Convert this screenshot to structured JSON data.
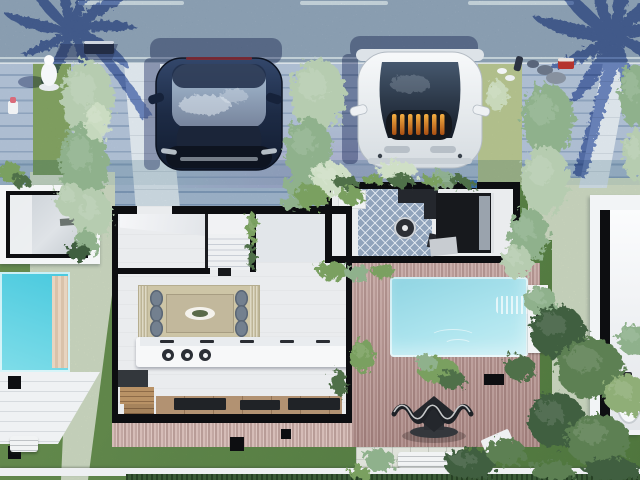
{
  "scene": {
    "description": "Photorealistic top-down 3D render of a modern villa lot between two neighbor houses, with street parking, palm-tree shadows, hedges, pools and gardens",
    "street": {
      "lane_dash_count": 3,
      "edge_lines": "double white sidewalk line",
      "palm_shadow_count": 2
    },
    "vehicles": [
      {
        "id": "suv",
        "label": "dark navy SUV parked on left driveway, nose toward house"
      },
      {
        "id": "sports-car",
        "label": "white sports car with orange engine bay visible under glass canopy"
      }
    ],
    "main_villa": {
      "rooms": [
        {
          "name": "entry hall with staircase"
        },
        {
          "name": "front den bedroom",
          "floor": "blue diamond-pattern tile",
          "furniture": [
            "dark bed with gray pillows",
            "corner sofa",
            "round coffee table",
            "white planter"
          ]
        },
        {
          "name": "open living-dining",
          "furniture": [
            "dining table with 6 gray chairs on beige rug",
            "white kitchen island with 3 basins",
            "wood media bench with dark cushions",
            "wood cabinets"
          ]
        }
      ],
      "courtyard": {
        "deck": "rosewood plank deck",
        "pool": "turquoise pool with white ledge and waterfall",
        "art": "dark wavy metal garden sculpture",
        "bench": "white garden bench"
      }
    },
    "left_neighbor": {
      "features": [
        "black-framed skylight roof window",
        "turquoise pool with sandstone ledge",
        "white patio deck",
        "black planter boxes",
        "white bench"
      ]
    },
    "right_neighbor": {
      "features": [
        "white roof terrace",
        "black-framed skylight with bathtub visible"
      ]
    },
    "landscaping": {
      "hedge_columns": 4,
      "trees": "dense green trees along right boundary and bottom edge",
      "lawn": "green grass",
      "paths": "pale sandy walkways",
      "street_items": [
        "white statue figure",
        "dark bench",
        "red cooler box",
        "gray stones"
      ]
    }
  },
  "palette": {
    "asphalt": "#95a1b6",
    "laneWhite": "#f4f6f8",
    "paver": "#b6c3d8",
    "paverLine": "#8fa2bf",
    "grass": "#6d8f44",
    "grassLight": "#7d9c4e",
    "sand": "#e9ebcb",
    "walkway": "#eef1f5",
    "shadow": "#6d87c3",
    "shadowDeep": "#55628f",
    "wall": "#0d0e11",
    "interior": "#eaecee",
    "tile": "#90a3bb",
    "rug": "#cdc5a6",
    "table": "#c2b89c",
    "chair": "#73808f",
    "island": "#f7f8f9",
    "cabinetWood": "#b99266",
    "benchWood": "#b29272",
    "cushion": "#202327",
    "poolMain": "#ace4ee",
    "poolEdge": "#f2f3f4",
    "poolNeighbor": "#7fdde9",
    "carDark": "#1d2b45",
    "carWhite": "#edf0f3",
    "engineGlow": "#e0892e",
    "sculpt": "#24272c",
    "bottomHedge": "#3a5a36",
    "hedgeLight": "#b6ccb0",
    "hedgeMid": "#8fb18c",
    "hedgePale": "#cfdfc6",
    "green": "#7aa061",
    "dark": "#4f7049",
    "tree": "#5d8053",
    "treeDark": "#415f3f",
    "treeLight": "#8fae77"
  },
  "foliage": [
    [
      10,
      172,
      13,
      9,
      "green"
    ],
    [
      21,
      181,
      9,
      6,
      "dark"
    ],
    [
      88,
      100,
      26,
      40,
      "hedgeLight"
    ],
    [
      84,
      165,
      24,
      42,
      "hedgeMid"
    ],
    [
      92,
      215,
      20,
      26,
      "hedgeLight"
    ],
    [
      97,
      122,
      13,
      20,
      "hedgePale",
      0.85
    ],
    [
      318,
      95,
      28,
      36,
      "hedgeLight"
    ],
    [
      308,
      150,
      24,
      32,
      "hedgeMid"
    ],
    [
      331,
      179,
      20,
      17,
      "hedgePale"
    ],
    [
      299,
      186,
      15,
      11,
      "hedgeMid"
    ],
    [
      398,
      172,
      20,
      11,
      "hedgePale"
    ],
    [
      441,
      180,
      15,
      9,
      "hedgeMid",
      0.9
    ],
    [
      548,
      120,
      26,
      36,
      "hedgeMid"
    ],
    [
      545,
      180,
      24,
      34,
      "hedgeLight"
    ],
    [
      529,
      235,
      20,
      26,
      "hedgeMid"
    ],
    [
      517,
      262,
      15,
      17,
      "hedgeLight"
    ],
    [
      634,
      95,
      15,
      32,
      "hedgeMid"
    ],
    [
      636,
      155,
      13,
      26,
      "hedgeLight"
    ],
    [
      70,
      200,
      15,
      17,
      "hedgeLight"
    ],
    [
      86,
      243,
      12,
      13,
      "hedgeMid"
    ],
    [
      79,
      252,
      12,
      8,
      "treeDark"
    ],
    [
      310,
      197,
      17,
      12,
      "green"
    ],
    [
      290,
      203,
      9,
      7,
      "hedgeMid"
    ],
    [
      346,
      182,
      13,
      6,
      "dark"
    ],
    [
      374,
      180,
      11,
      5,
      "green"
    ],
    [
      402,
      181,
      13,
      6,
      "dark"
    ],
    [
      432,
      181,
      11,
      5,
      "green"
    ],
    [
      459,
      180,
      9,
      5,
      "dark"
    ],
    [
      352,
      196,
      12,
      9,
      "green"
    ],
    [
      470,
      184,
      7,
      4,
      "dark"
    ],
    [
      252,
      228,
      5,
      16,
      "green"
    ],
    [
      252,
      256,
      4,
      13,
      "dark"
    ],
    [
      339,
      383,
      8,
      13,
      "dark"
    ],
    [
      332,
      271,
      15,
      9,
      "green"
    ],
    [
      357,
      273,
      13,
      8,
      "hedgeMid"
    ],
    [
      383,
      271,
      12,
      7,
      "green"
    ],
    [
      363,
      356,
      12,
      17,
      "green"
    ],
    [
      438,
      370,
      20,
      13,
      "green"
    ],
    [
      452,
      380,
      14,
      9,
      "dark"
    ],
    [
      426,
      362,
      10,
      8,
      "hedgeMid"
    ],
    [
      520,
      368,
      15,
      13,
      "dark"
    ],
    [
      540,
      300,
      16,
      14,
      "hedgeMid"
    ],
    [
      558,
      332,
      28,
      26,
      "treeDark"
    ],
    [
      590,
      368,
      34,
      30,
      "tree"
    ],
    [
      556,
      420,
      28,
      28,
      "treeDark"
    ],
    [
      598,
      440,
      32,
      26,
      "tree"
    ],
    [
      626,
      395,
      22,
      20,
      "treeLight"
    ],
    [
      634,
      340,
      17,
      15,
      "hedgeMid"
    ],
    [
      470,
      464,
      26,
      15,
      "treeDark"
    ],
    [
      506,
      452,
      20,
      13,
      "tree"
    ],
    [
      612,
      470,
      28,
      12,
      "treeDark"
    ],
    [
      553,
      471,
      22,
      10,
      "tree"
    ],
    [
      380,
      460,
      15,
      11,
      "hedgeMid"
    ],
    [
      360,
      473,
      11,
      7,
      "green"
    ],
    [
      497,
      96,
      11,
      15,
      "hedgePale",
      0.8
    ]
  ]
}
